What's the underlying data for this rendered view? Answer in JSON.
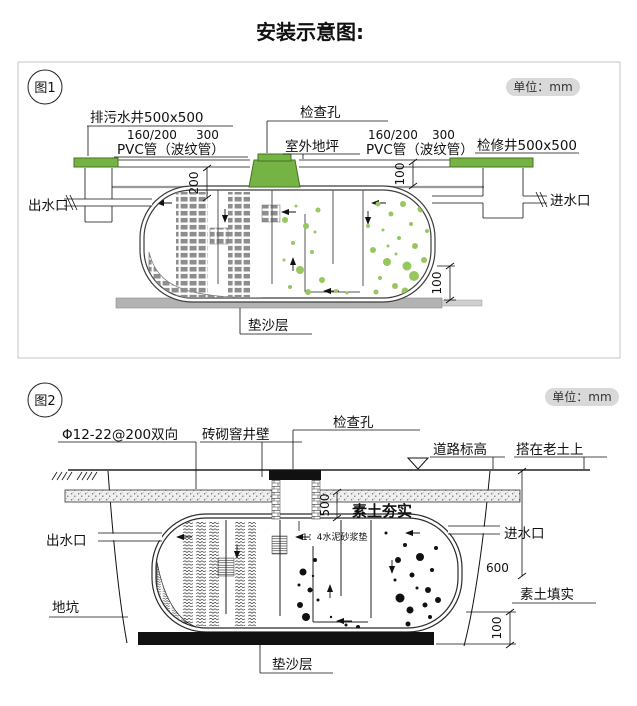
{
  "page": {
    "title": "安装示意图:"
  },
  "fig1": {
    "tag": "图1",
    "unit": "单位：mm",
    "labels": {
      "sewage_well": "排污水井500x500",
      "pipe_dim_a": "160/200",
      "pipe_dim_b": "300",
      "pvc_pipe_left": "PVC管（波纹管）",
      "inspection_hole": "检查孔",
      "outdoor_ground": "室外地坪",
      "pipe_dim_a2": "160/200",
      "pipe_dim_b2": "300",
      "pvc_pipe_right": "PVC管（波纹管）",
      "access_well": "检修井500x500",
      "outlet": "出水口",
      "inlet": "进水口",
      "sand_layer": "垫沙层"
    },
    "dims": {
      "d200": "200",
      "d100_top": "100",
      "d100_bottom": "100"
    }
  },
  "fig2": {
    "tag": "图2",
    "unit": "单位：mm",
    "labels": {
      "rebar": "Φ12-22@200双向",
      "brick_wall": "砖砌窨井壁",
      "inspection_hole": "检查孔",
      "road_level": "道路标高",
      "on_old_soil": "搭在老土上",
      "compacted_soil": "素土夯实",
      "mortar_pad": "1：4水泥砂浆垫",
      "outlet": "出水口",
      "inlet": "进水口",
      "soil_backfill": "素土填实",
      "pit": "地坑",
      "sand_layer": "垫沙层"
    },
    "dims": {
      "d500": "500",
      "d600": "600",
      "d100": "100"
    }
  },
  "colors": {
    "green_fitting": "#76b345",
    "bubble_green": "#97c75f",
    "media_gray": "#8e8e8e",
    "sand_gray": "#b3b3b3",
    "badge_bg": "#d9d9d9",
    "panel_border": "#c5c5c5"
  }
}
